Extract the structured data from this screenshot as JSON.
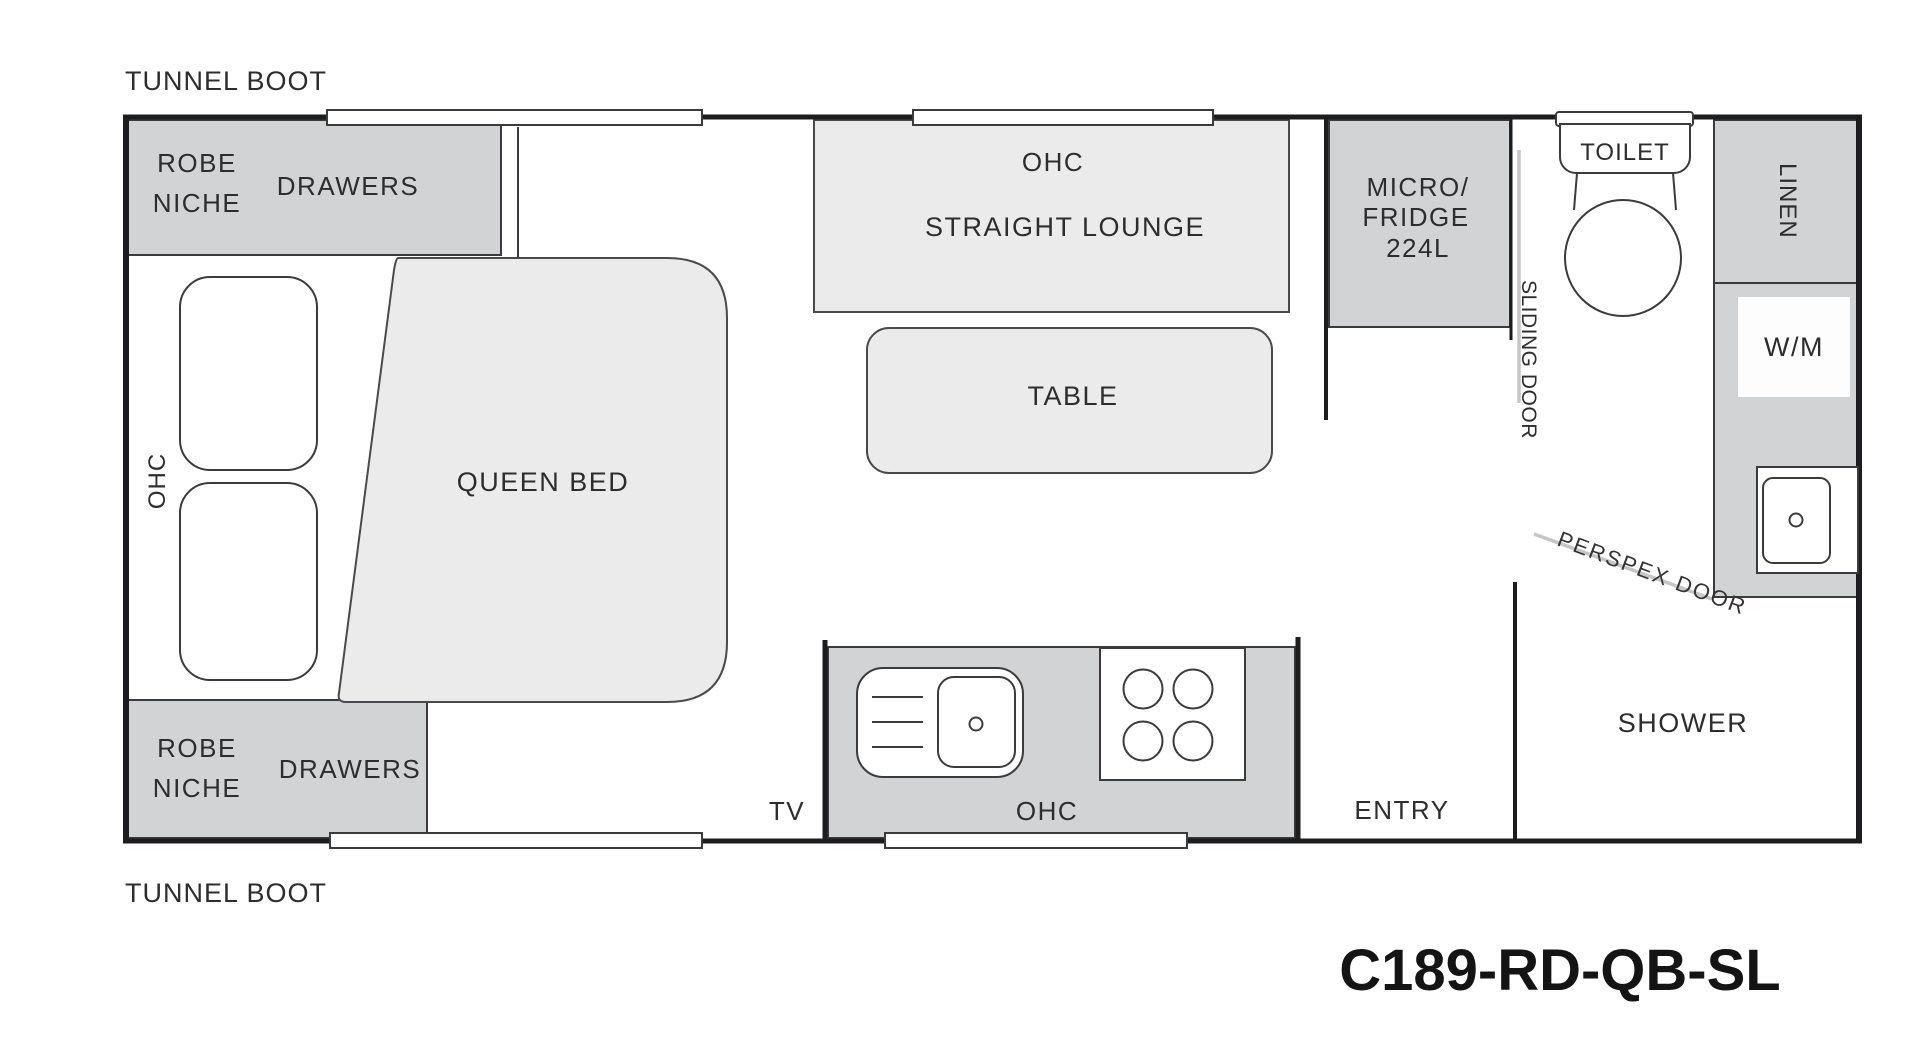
{
  "page": {
    "model_code": "C189-RD-QB-SL"
  },
  "colors": {
    "block_dark": "#d2d3d5",
    "block_light": "#ebebec",
    "fixture_white": "#ffffff",
    "wall": "#1d1d1f",
    "door_line": "#c6c6c8",
    "text": "#2d2d2e"
  },
  "labels": {
    "tunnel_boot_top": "TUNNEL BOOT",
    "tunnel_boot_bottom": "TUNNEL BOOT",
    "robe_top_line1": "ROBE",
    "robe_top_line2": "NICHE",
    "drawers_top": "DRAWERS",
    "robe_bottom_line1": "ROBE",
    "robe_bottom_line2": "NICHE",
    "drawers_bottom": "DRAWERS",
    "ohc_bedroom": "OHC",
    "queen_bed": "QUEEN BED",
    "lounge_ohc": "OHC",
    "straight_lounge": "STRAIGHT LOUNGE",
    "table": "TABLE",
    "micro_line1": "MICRO/",
    "micro_line2": "FRIDGE",
    "micro_line3": "224L",
    "sliding_door": "SLIDING DOOR",
    "toilet": "TOILET",
    "linen": "LINEN",
    "wm": "W/M",
    "perspex_door": "PERSPEX DOOR",
    "shower": "SHOWER",
    "entry": "ENTRY",
    "tv": "TV",
    "kitchen_ohc": "OHC"
  }
}
